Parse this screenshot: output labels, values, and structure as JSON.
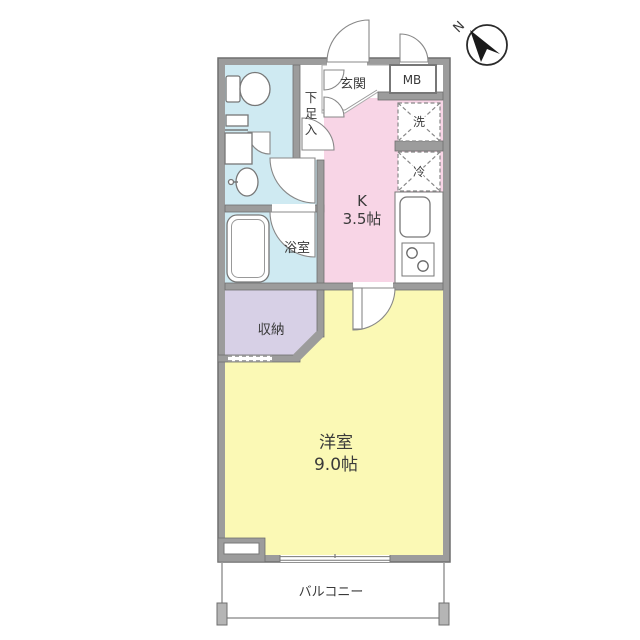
{
  "compass": {
    "north_label": "N"
  },
  "labels": {
    "entrance": "玄関",
    "meter_box": "MB",
    "shoe_cabinet_chars": [
      "下",
      "足",
      "入"
    ],
    "kitchen_name": "K",
    "kitchen_size": "3.5帖",
    "washer": "洗",
    "refrigerator": "冷",
    "bathroom": "浴室",
    "storage": "収納",
    "western_room_name": "洋室",
    "western_room_size": "9.0帖",
    "balcony": "バルコニー"
  },
  "colors": {
    "wall": "#9c9c9c",
    "wall_outline": "#6f6f6f",
    "sanitary_blue": "#cfeaf2",
    "kitchen_pink": "#f8d5e6",
    "storage_purple": "#d7d0e6",
    "room_yellow": "#fbf9b5",
    "line_gray": "#888888",
    "text": "#3a3a3a"
  }
}
